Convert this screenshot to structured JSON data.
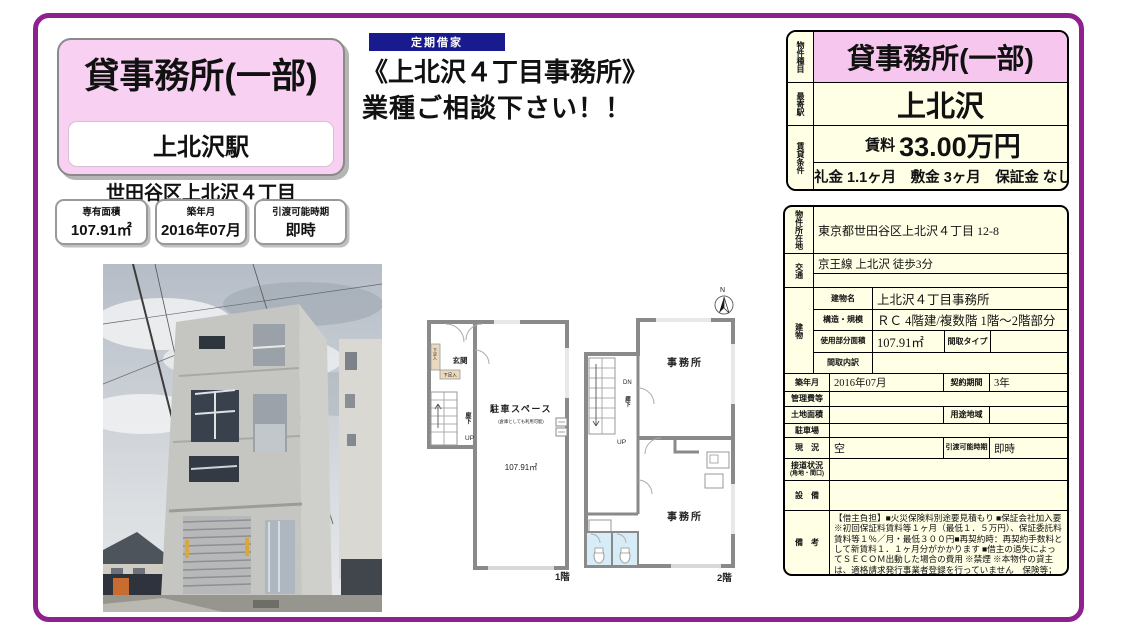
{
  "colors": {
    "frame": "#8e2090",
    "pink": "#f8d0f2",
    "pink_header": "#f6c6ee",
    "cream": "#ffffe6",
    "navy": "#1a1a8f"
  },
  "left": {
    "title": "貸事務所(一部)",
    "station": "上北沢駅",
    "address": "世田谷区上北沢４丁目",
    "badges": [
      {
        "label": "専有面積",
        "value": "107.91㎡"
      },
      {
        "label": "築年月",
        "value": "2016年07月"
      },
      {
        "label": "引渡可能時期",
        "value": "即時"
      }
    ]
  },
  "headline": {
    "tag": "定期借家",
    "line1": "《上北沢４丁目事務所》",
    "line2": "業種ご相談下さい！！"
  },
  "summary": {
    "type_label": "物件種目",
    "type_value": "貸事務所(一部)",
    "station_label": "最寄駅",
    "station_value": "上北沢",
    "terms_label": "賃貸条件",
    "rent_label": "賃料",
    "rent_value": "33.00万円",
    "fees_value": "礼金 1.1ヶ月　敷金 3ヶ月　保証金 なし"
  },
  "detail": {
    "location_label": "物件所在地",
    "location_value": "東京都世田谷区上北沢４丁目 12-8",
    "access_label": "交通",
    "access_value": "京王線 上北沢 徒歩3分",
    "access_value2": "",
    "building_label": "建物",
    "building_name_label": "建物名",
    "building_name_value": "上北沢４丁目事務所",
    "structure_label": "構造・規模",
    "structure_value": "ＲＣ 4階建/複数階 1階～2階部分",
    "area_label": "使用部分面積",
    "area_value": "107.91㎡",
    "layout_type_label": "間取タイプ",
    "layout_type_value": "",
    "layout_breakdown_label": "間取内訳",
    "layout_breakdown_value": "",
    "built_label": "築年月",
    "built_value": "2016年07月",
    "contract_label": "契約期間",
    "contract_value": "3年",
    "management_label": "管理費等",
    "management_value": "",
    "land_label": "土地面積",
    "land_value": "",
    "zoning_label": "用途地域",
    "zoning_value": "",
    "parking_label": "駐車場",
    "parking_value": "",
    "status_label": "現　況",
    "status_value": "空",
    "handover_label": "引渡可能時期",
    "handover_value": "即時",
    "road_label": "接道状況",
    "road_label2": "(角地・間口)",
    "road_value": "",
    "equipment_label": "設　備",
    "equipment_value": "",
    "remarks_label": "備　考",
    "remarks_value": "【借主負担】■火災保険料別途要見積もり ■保証会社加入要※初回保証料賃料等１ヶ月（最低１．５万円）、保証委託料賃料等１％／月・最低３００円■再契約時：再契約手数料として新賃料１．１ヶ月分がかかります ■借主の過失によってＳＥＣＯＭ出動した場合の費用 ※禁煙 ※本物件の貸主は、適格請求発行事業者登録を行っていません　保険等；要　更新料；なし　賃貸保証；加入要■保証会社加入要※初回保証料賃料等１ヶ月（最低１．５万円）、保証委託料賃料等１％／月・最低３００円"
  },
  "plan1": {
    "entrance": "玄関",
    "shoe_box1": "下足入",
    "shoe_box2": "下足入",
    "corridor": "廊下",
    "up": "UP",
    "room": "駐車スペース",
    "room_note": "(倉庫としても利用可能)",
    "area": "107.91㎡",
    "floor": "1階"
  },
  "plan2": {
    "north": "N",
    "office1": "事務所",
    "office2": "事務所",
    "dn": "DN",
    "corridor": "廊下",
    "up": "UP",
    "floor": "2階"
  }
}
